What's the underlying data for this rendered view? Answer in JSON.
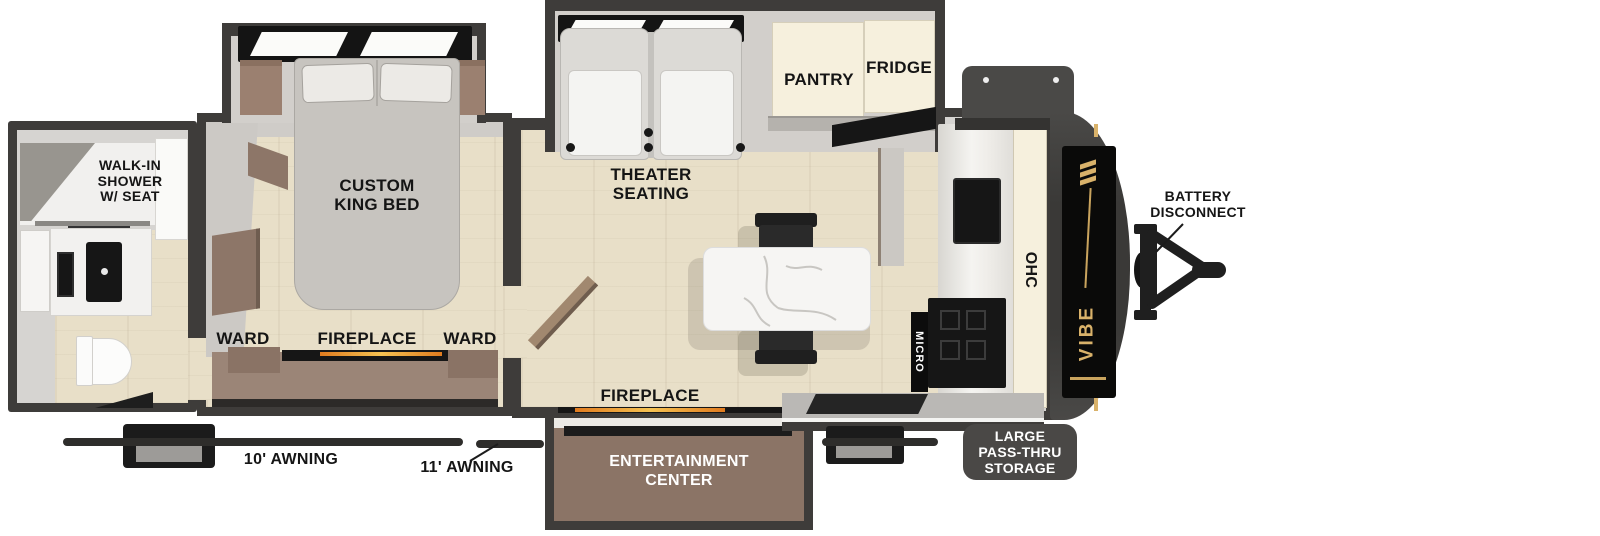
{
  "brand": "VIBE",
  "labels": {
    "shower": "WALK-IN\nSHOWER\nW/ SEAT",
    "king_bed": "CUSTOM\nKING BED",
    "ward_left": "WARD",
    "fireplace_bedroom": "FIREPLACE",
    "ward_right": "WARD",
    "theater_seating": "THEATER\nSEATING",
    "pantry": "PANTRY",
    "fridge": "FRIDGE",
    "fireplace_living": "FIREPLACE",
    "entertainment_center": "ENTERTAINMENT\nCENTER",
    "ohc": "OHC",
    "micro": "MICRO",
    "battery_disconnect": "BATTERY\nDISCONNECT",
    "pass_thru_storage": "LARGE\nPASS-THRU\nSTORAGE",
    "awning_rear": "10' AWNING",
    "awning_main": "11' AWNING"
  },
  "colors": {
    "wall": "#3e3c3a",
    "floor": "#e8dfc8",
    "interior_gray": "#d6d4d1",
    "slide_gray": "#d2cfcb",
    "cream_cabinet": "#f6f0dd",
    "brown_furniture": "#977e6e",
    "appliance_black": "#161616",
    "fire_glow": "#f2a93b",
    "brand_gold": "#d9b26a",
    "badge_gray": "#4a4846",
    "label_black": "#151515"
  }
}
